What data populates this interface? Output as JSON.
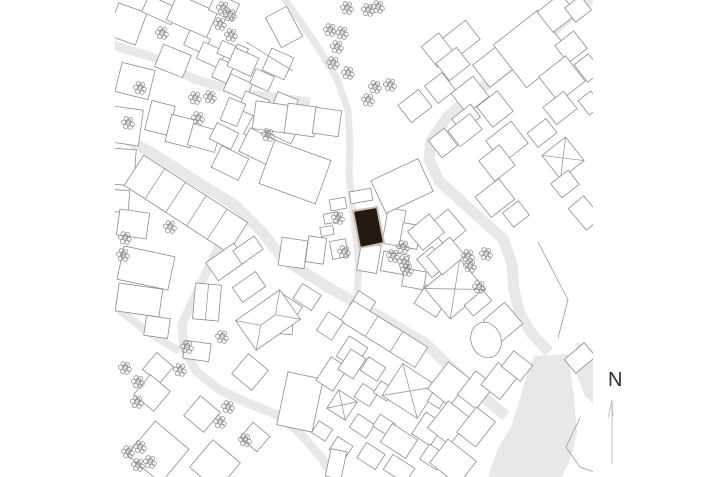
{
  "north_indicator": {
    "label": "N"
  },
  "colors": {
    "background": "#ffffff",
    "road": "#e8e8ea",
    "building_fill": "#ffffff",
    "building_stroke": "#8e8e8e",
    "site_fill": "#231a12",
    "site_outline": "#c6c0ba",
    "tree": "#919191",
    "fence": "#9a9a9a",
    "north_text": "#2e2e2e",
    "north_line": "#c2c2c2"
  },
  "map": {
    "clip": {
      "x": 115,
      "y": 0,
      "w": 478,
      "h": 477
    },
    "roads": [
      {
        "w": 9,
        "p": [
          [
            113,
            45
          ],
          [
            152,
            57
          ],
          [
            196,
            80
          ],
          [
            247,
            94
          ],
          [
            310,
            102
          ]
        ]
      },
      {
        "w": 7,
        "p": [
          [
            284,
            -2
          ],
          [
            301,
            22
          ],
          [
            319,
            49
          ],
          [
            337,
            79
          ],
          [
            348,
            110
          ],
          [
            350,
            143
          ],
          [
            349,
            172
          ],
          [
            352,
            203
          ],
          [
            356,
            237
          ],
          [
            359,
            268
          ],
          [
            357,
            296
          ]
        ]
      },
      {
        "w": 11,
        "p": [
          [
            112,
            131
          ],
          [
            152,
            153
          ],
          [
            196,
            181
          ],
          [
            236,
            206
          ],
          [
            263,
            233
          ],
          [
            283,
            259
          ],
          [
            331,
            289
          ],
          [
            379,
            316
          ],
          [
            425,
            343
          ],
          [
            471,
            387
          ],
          [
            506,
            416
          ]
        ]
      },
      {
        "w": 11,
        "p": [
          [
            591,
            -2
          ],
          [
            540,
            42
          ],
          [
            492,
            80
          ],
          [
            448,
            116
          ],
          [
            431,
            141
          ],
          [
            429,
            159
          ],
          [
            439,
            181
          ],
          [
            459,
            199
          ],
          [
            481,
            219
          ],
          [
            503,
            239
          ],
          [
            512,
            264
          ],
          [
            514,
            290
          ],
          [
            520,
            314
          ],
          [
            532,
            334
          ],
          [
            549,
            352
          ]
        ]
      },
      {
        "w": 9,
        "p": [
          [
            248,
            212
          ],
          [
            219,
            246
          ],
          [
            199,
            288
          ],
          [
            182,
            324
          ],
          [
            184,
            350
          ],
          [
            197,
            372
          ],
          [
            220,
            390
          ],
          [
            250,
            404
          ],
          [
            278,
            415
          ],
          [
            299,
            432
          ],
          [
            321,
            457
          ],
          [
            334,
            478
          ]
        ]
      },
      {
        "w": 8,
        "p": [
          [
            112,
            304
          ],
          [
            146,
            331
          ],
          [
            179,
            351
          ]
        ]
      }
    ],
    "patches": [
      [
        [
          534,
          356
        ],
        [
          568,
          354
        ],
        [
          574,
          398
        ],
        [
          577,
          434
        ],
        [
          569,
          462
        ],
        [
          561,
          478
        ],
        [
          488,
          478
        ],
        [
          497,
          450
        ],
        [
          511,
          427
        ],
        [
          521,
          395
        ],
        [
          528,
          372
        ]
      ],
      [
        [
          577,
          342
        ],
        [
          599,
          353
        ],
        [
          599,
          410
        ],
        [
          585,
          396
        ],
        [
          573,
          366
        ]
      ]
    ],
    "buildings": [
      [
        127,
        24,
        30,
        34,
        20
      ],
      [
        160,
        10,
        32,
        18,
        24
      ],
      [
        192,
        16,
        44,
        28,
        24
      ],
      [
        224,
        7,
        26,
        18,
        24
      ],
      [
        197,
        42,
        22,
        16,
        24
      ],
      [
        211,
        55,
        24,
        18,
        24
      ],
      [
        173,
        61,
        30,
        24,
        22
      ],
      [
        135,
        81,
        34,
        30,
        14
      ],
      [
        126,
        126,
        30,
        36,
        8
      ],
      [
        160,
        118,
        24,
        30,
        14
      ],
      [
        181,
        131,
        26,
        28,
        14
      ],
      [
        204,
        138,
        28,
        22,
        16
      ],
      [
        227,
        50,
        16,
        14,
        24
      ],
      [
        241,
        51,
        12,
        10,
        24
      ],
      [
        223,
        71,
        16,
        20,
        24
      ],
      [
        278,
        64,
        24,
        24,
        24
      ],
      [
        243,
        62,
        26,
        20,
        24
      ],
      [
        238,
        87,
        24,
        18,
        24
      ],
      [
        262,
        80,
        20,
        16,
        24
      ],
      [
        254,
        105,
        26,
        20,
        22
      ],
      [
        284,
        106,
        22,
        22,
        22
      ],
      [
        233,
        112,
        18,
        24,
        22
      ],
      [
        224,
        136,
        24,
        18,
        26
      ],
      [
        258,
        130,
        22,
        20,
        28
      ],
      [
        283,
        128,
        28,
        22,
        26
      ],
      [
        230,
        163,
        30,
        24,
        26
      ],
      [
        258,
        146,
        30,
        26,
        26
      ],
      [
        271,
        117,
        34,
        28,
        8
      ],
      [
        301,
        120,
        30,
        30,
        8
      ],
      [
        327,
        122,
        26,
        26,
        8
      ],
      [
        284,
        27,
        24,
        34,
        -28
      ],
      [
        124,
        167,
        22,
        36,
        4
      ],
      [
        121,
        201,
        16,
        22,
        4
      ],
      [
        186,
        204,
        124,
        36,
        33,
        "",
        5
      ],
      [
        133,
        224,
        30,
        26,
        8
      ],
      [
        295,
        172,
        60,
        46,
        20
      ],
      [
        461,
        39,
        30,
        24,
        -38
      ],
      [
        438,
        50,
        22,
        26,
        -38
      ],
      [
        453,
        64,
        26,
        22,
        -38
      ],
      [
        440,
        88,
        22,
        22,
        -38
      ],
      [
        470,
        95,
        28,
        26,
        -38
      ],
      [
        493,
        67,
        30,
        28,
        -38
      ],
      [
        466,
        118,
        24,
        16,
        -38
      ],
      [
        495,
        109,
        26,
        26,
        -38
      ],
      [
        532,
        49,
        56,
        54,
        -38
      ],
      [
        557,
        13,
        30,
        26,
        -38
      ],
      [
        578,
        9,
        20,
        18,
        -38
      ],
      [
        571,
        47,
        24,
        22,
        -38
      ],
      [
        562,
        79,
        34,
        32,
        -38
      ],
      [
        588,
        68,
        18,
        22,
        -38
      ],
      [
        560,
        108,
        26,
        22,
        -38
      ],
      [
        590,
        103,
        16,
        18,
        -38
      ],
      [
        465,
        130,
        28,
        20,
        -38
      ],
      [
        443,
        143,
        20,
        22,
        -38
      ],
      [
        507,
        142,
        32,
        28,
        -38
      ],
      [
        563,
        158,
        30,
        30,
        -38,
        "x"
      ],
      [
        542,
        133,
        24,
        18,
        -38
      ],
      [
        497,
        163,
        26,
        26,
        -38
      ],
      [
        565,
        184,
        22,
        18,
        -38
      ],
      [
        585,
        213,
        20,
        28,
        -40
      ],
      [
        415,
        106,
        26,
        22,
        -38
      ],
      [
        495,
        198,
        30,
        26,
        -38
      ],
      [
        516,
        214,
        20,
        18,
        -38
      ],
      [
        447,
        228,
        26,
        28,
        -40
      ],
      [
        361,
        196,
        22,
        12,
        -10
      ],
      [
        338,
        204,
        16,
        11,
        -10
      ],
      [
        331,
        218,
        14,
        10,
        -10
      ],
      [
        327,
        231,
        13,
        9,
        -10
      ],
      [
        339,
        249,
        16,
        18,
        -10
      ],
      [
        394,
        227,
        18,
        36,
        10
      ],
      [
        410,
        236,
        18,
        24,
        10
      ],
      [
        402,
        186,
        52,
        36,
        -25
      ],
      [
        426,
        232,
        28,
        24,
        -40
      ],
      [
        293,
        253,
        26,
        28,
        8
      ],
      [
        316,
        250,
        18,
        26,
        8
      ],
      [
        307,
        297,
        22,
        18,
        33
      ],
      [
        288,
        307,
        24,
        16,
        33
      ],
      [
        283,
        322,
        20,
        24,
        4
      ],
      [
        369,
        258,
        20,
        28,
        10
      ],
      [
        395,
        263,
        26,
        20,
        10
      ],
      [
        414,
        279,
        22,
        18,
        10
      ],
      [
        432,
        262,
        20,
        24,
        -40
      ],
      [
        431,
        301,
        26,
        22,
        33
      ],
      [
        363,
        303,
        20,
        16,
        33
      ],
      [
        384,
        334,
        88,
        24,
        32,
        "",
        3
      ],
      [
        330,
        326,
        18,
        22,
        33
      ],
      [
        352,
        352,
        22,
        24,
        33
      ],
      [
        146,
        268,
        52,
        34,
        12
      ],
      [
        139,
        300,
        44,
        28,
        8
      ],
      [
        157,
        327,
        24,
        20,
        8
      ],
      [
        207,
        302,
        26,
        36,
        5,
        "",
        2
      ],
      [
        197,
        351,
        26,
        18,
        8
      ],
      [
        268,
        320,
        54,
        36,
        -35,
        "h"
      ],
      [
        249,
        287,
        28,
        18,
        -35
      ],
      [
        226,
        262,
        34,
        22,
        -35
      ],
      [
        248,
        250,
        26,
        16,
        -35
      ],
      [
        158,
        368,
        22,
        22,
        40
      ],
      [
        152,
        393,
        26,
        26,
        40
      ],
      [
        202,
        414,
        26,
        26,
        40
      ],
      [
        255,
        437,
        22,
        20,
        40
      ],
      [
        250,
        372,
        26,
        26,
        40
      ],
      [
        158,
        452,
        44,
        44,
        40
      ],
      [
        215,
        465,
        36,
        36,
        40
      ],
      [
        300,
        402,
        36,
        54,
        12
      ],
      [
        332,
        374,
        20,
        28,
        33
      ],
      [
        352,
        364,
        18,
        24,
        33
      ],
      [
        373,
        369,
        20,
        16,
        33
      ],
      [
        342,
        405,
        22,
        22,
        33,
        "h"
      ],
      [
        366,
        395,
        18,
        16,
        33
      ],
      [
        384,
        391,
        16,
        14,
        33
      ],
      [
        410,
        391,
        42,
        38,
        33,
        "x"
      ],
      [
        437,
        399,
        14,
        14,
        33
      ],
      [
        362,
        426,
        20,
        16,
        33
      ],
      [
        384,
        425,
        18,
        14,
        33
      ],
      [
        399,
        441,
        30,
        22,
        33
      ],
      [
        371,
        456,
        22,
        18,
        33
      ],
      [
        341,
        448,
        18,
        16,
        33
      ],
      [
        322,
        431,
        16,
        14,
        33
      ],
      [
        336,
        464,
        16,
        28,
        12
      ],
      [
        399,
        469,
        26,
        18,
        33
      ],
      [
        428,
        429,
        22,
        26,
        33
      ],
      [
        433,
        457,
        20,
        18,
        33
      ],
      [
        449,
        384,
        28,
        34,
        38
      ],
      [
        476,
        390,
        24,
        30,
        38
      ],
      [
        499,
        381,
        24,
        28,
        38
      ],
      [
        449,
        423,
        28,
        34,
        38
      ],
      [
        476,
        427,
        24,
        32,
        38
      ],
      [
        453,
        462,
        36,
        30,
        38
      ],
      [
        517,
        366,
        24,
        20,
        38
      ],
      [
        455,
        289,
        46,
        40,
        -40,
        "x"
      ],
      [
        446,
        256,
        30,
        24,
        -40
      ],
      [
        478,
        303,
        24,
        14,
        -40
      ],
      [
        503,
        322,
        28,
        28,
        -40
      ],
      [
        580,
        358,
        26,
        18,
        -40
      ]
    ],
    "ellipses": [
      {
        "cx": 486,
        "cy": 340,
        "rx": 15,
        "ry": 18,
        "a": -20
      }
    ],
    "site": {
      "points": [
        [
          353,
          211
        ],
        [
          377,
          207
        ],
        [
          384,
          243
        ],
        [
          360,
          248
        ]
      ]
    },
    "fences": [
      [
        [
          538,
          242
        ],
        [
          568,
          300
        ],
        [
          558,
          338
        ]
      ],
      [
        [
          580,
          418
        ],
        [
          566,
          447
        ],
        [
          580,
          467
        ],
        [
          594,
          472
        ]
      ],
      [
        [
          246,
          42
        ],
        [
          293,
          71
        ]
      ]
    ],
    "trees": [
      [
        162,
        33
      ],
      [
        223,
        8
      ],
      [
        230,
        15
      ],
      [
        220,
        24
      ],
      [
        231,
        35
      ],
      [
        347,
        8
      ],
      [
        368,
        10
      ],
      [
        378,
        7
      ],
      [
        330,
        30
      ],
      [
        342,
        33
      ],
      [
        337,
        47
      ],
      [
        333,
        63
      ],
      [
        348,
        73
      ],
      [
        375,
        87
      ],
      [
        390,
        85
      ],
      [
        368,
        100
      ],
      [
        140,
        88
      ],
      [
        128,
        123
      ],
      [
        195,
        98
      ],
      [
        210,
        97
      ],
      [
        198,
        118
      ],
      [
        268,
        135
      ],
      [
        170,
        227
      ],
      [
        125,
        238
      ],
      [
        123,
        255
      ],
      [
        338,
        218
      ],
      [
        344,
        252
      ],
      [
        403,
        247
      ],
      [
        393,
        256
      ],
      [
        404,
        262
      ],
      [
        407,
        270
      ],
      [
        468,
        256
      ],
      [
        486,
        254
      ],
      [
        470,
        266
      ],
      [
        479,
        287
      ],
      [
        222,
        337
      ],
      [
        187,
        347
      ],
      [
        125,
        368
      ],
      [
        138,
        382
      ],
      [
        137,
        402
      ],
      [
        180,
        370
      ],
      [
        228,
        407
      ],
      [
        220,
        422
      ],
      [
        245,
        440
      ],
      [
        140,
        447
      ],
      [
        128,
        452
      ],
      [
        150,
        462
      ],
      [
        138,
        465
      ]
    ]
  }
}
